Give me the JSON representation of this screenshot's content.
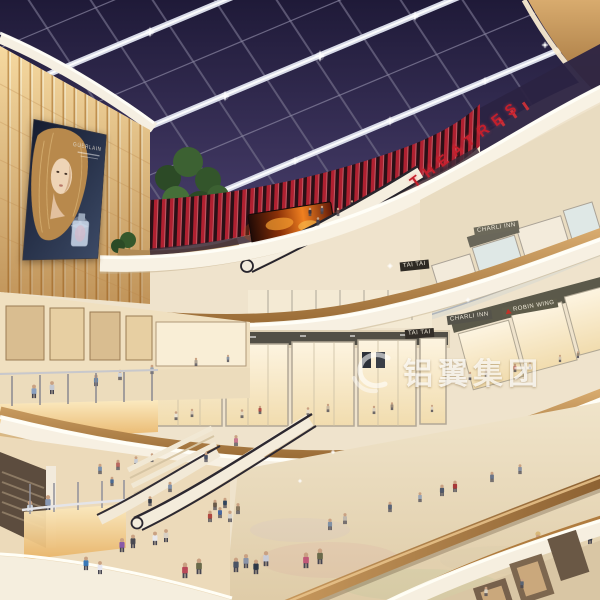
{
  "scene": {
    "type": "architectural-rendering",
    "subject": "multi-level shopping mall atrium at dusk under a glazed grid skylight"
  },
  "signs": {
    "theatres": "THEATRES",
    "tai_tai_upper": "TAI TAI",
    "tai_tai_lower": "TAI TAI",
    "charli_inn_upper": "CHARLI INN",
    "charli_inn_lower": "CHARLI INN",
    "robin_wing": "ROBIN WING"
  },
  "billboard": {
    "brand": "GUERLAIN"
  },
  "watermark": {
    "text": "铝翼集团"
  },
  "palette": {
    "sky": "#352e55",
    "beam": "#e8eaf4",
    "glow_wall": "#f6d89e",
    "fascia": "#f7f0e2",
    "wood": "#bf8e54",
    "floor": "#e9dabb",
    "theatre_red": "#b32331"
  }
}
